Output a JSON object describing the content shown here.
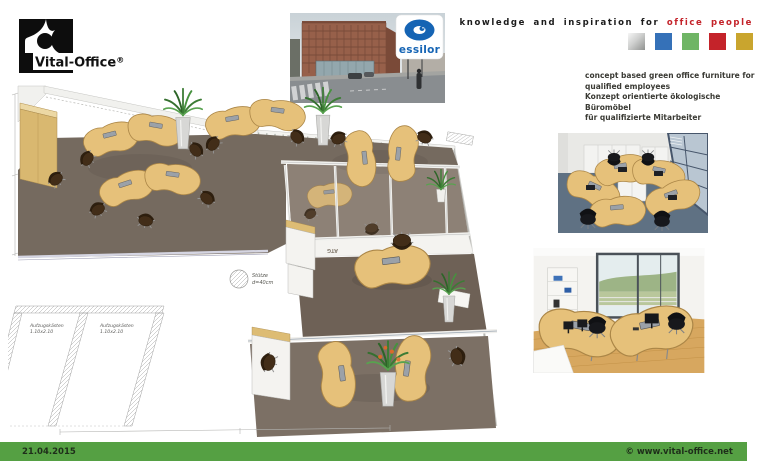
{
  "header": {
    "logo": {
      "name": "Vital-Office",
      "reg": "®"
    },
    "tagline": {
      "black": "knowledge and inspiration for",
      "red": "office people"
    },
    "palette": [
      {
        "name": "silver",
        "color": "#b9bab9"
      },
      {
        "name": "blue",
        "color": "#3571b8"
      },
      {
        "name": "green",
        "color": "#6fb565"
      },
      {
        "name": "red",
        "color": "#c4232a"
      },
      {
        "name": "gold",
        "color": "#c9a52e"
      }
    ],
    "concept": {
      "line1": "concept based green office furniture for",
      "line2": "qualified employees",
      "line3": "Konzept orientierte ökologische Büromöbel",
      "line4": "für qualifizierte Mitarbeiter"
    },
    "building_photo": {
      "brand": "essilor",
      "brand_color": "#1564b4"
    }
  },
  "floorplan": {
    "labels": {
      "column_line1": "Stütze",
      "column_line2": "d=40cm",
      "elevator_line1": "Aufzugskästen",
      "elevator_line2": "1.10x2.10",
      "floor_code": "ATG"
    }
  },
  "footer": {
    "date": "21.04.2015",
    "website": "© www.vital-office.net",
    "bar_color": "#55a043"
  }
}
